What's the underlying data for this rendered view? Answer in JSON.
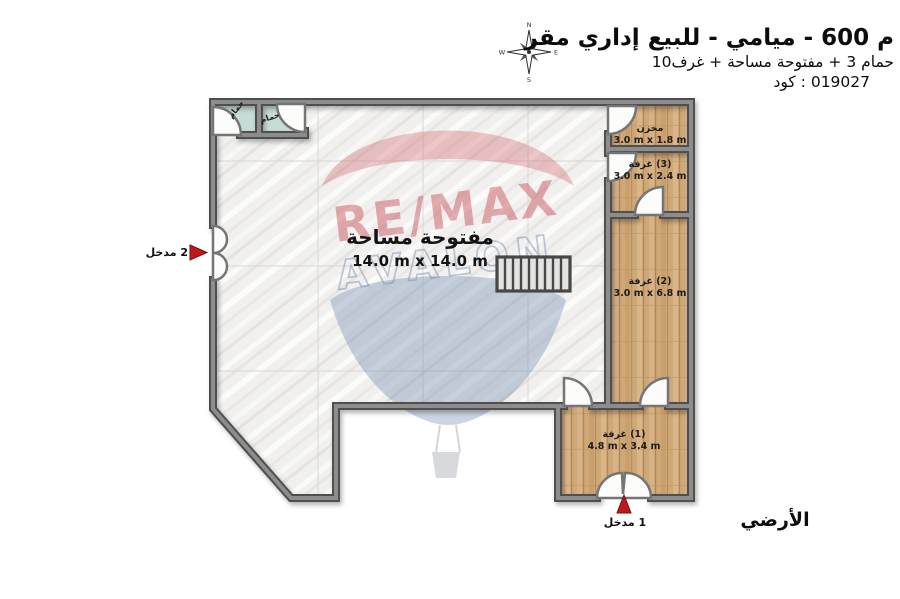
{
  "header": {
    "title": "⁨مقر⁩ ⁨إداري⁩ ⁨للبيع⁩ - ⁨ميامي⁩ - 600 ⁨م⁩",
    "subtitle": "10⁨غرف⁩ + ⁨مساحة⁩ ⁨مفتوحة⁩ + 3 ⁨حمام⁩",
    "code": "⁨كود⁩ : 019027"
  },
  "compass": {
    "north": "N",
    "east": "E",
    "south": "S",
    "west": "W"
  },
  "watermark": {
    "brand": "RE/MAX",
    "agency": "AVALON"
  },
  "plan": {
    "open_space": {
      "name": "⁨مساحة⁩ ⁨مفتوحة⁩",
      "dims": "14.0 m x 14.0 m"
    },
    "storage": {
      "name": "⁨مخزن⁩",
      "dims": "3.0 m x 1.8 m"
    },
    "room3": {
      "name": "⁨غرفة⁩ (3)",
      "dims": "3.0 m x 2.4 m"
    },
    "room2": {
      "name": "⁨غرفة⁩ (2)",
      "dims": "3.0 m x 6.8 m"
    },
    "room1": {
      "name": "⁨غرفة⁩ (1)",
      "dims": "4.8 m x 3.4 m"
    },
    "bath_left": {
      "name": "⁨حمام⁩"
    },
    "bath_right": {
      "name": "⁨حمام⁩"
    },
    "entrance_1": "⁨مدخل⁩ 1",
    "entrance_2": "⁨مدخل⁩ 2"
  },
  "floor_label": "⁨الأرضي⁩",
  "colors": {
    "wall_dark": "#4f4f4f",
    "wall_light": "#8d8d8d",
    "wood": "#cfa878",
    "marble": "#f0efed",
    "bath_floor": "#c7dcd6",
    "arrow_red": "#c0181c",
    "watermark_red": "#c5404a",
    "watermark_blue": "#7d93b5"
  }
}
